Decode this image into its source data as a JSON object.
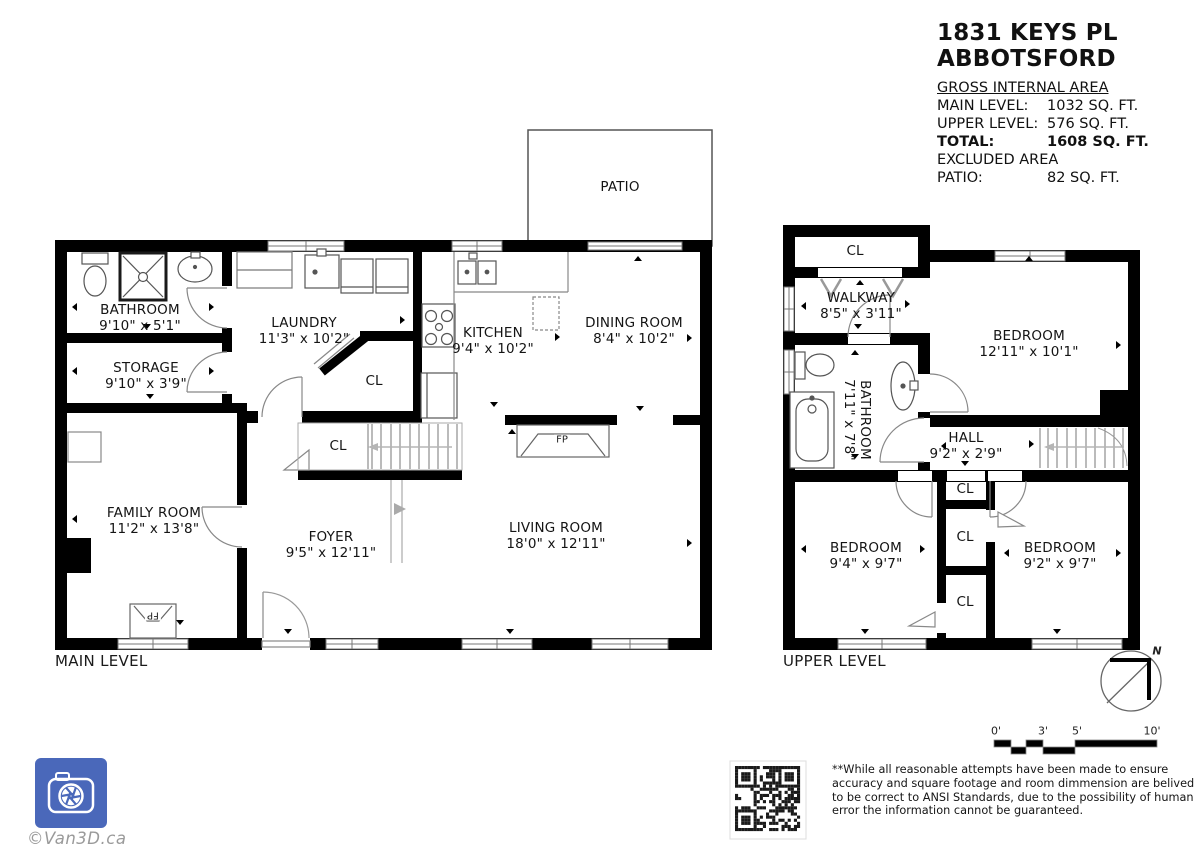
{
  "header": {
    "address_line1": "1831 KEYS PL",
    "address_line2": "ABBOTSFORD",
    "gross_title": "GROSS INTERNAL AREA",
    "rows": [
      {
        "label": "MAIN LEVEL:",
        "value": "1032 SQ. FT."
      },
      {
        "label": "UPPER LEVEL:",
        "value": "576 SQ. FT."
      },
      {
        "label": "TOTAL:",
        "value": "1608 SQ. FT."
      }
    ],
    "excluded_title": "EXCLUDED AREA",
    "excluded_row": {
      "label": "PATIO:",
      "value": "82 SQ. FT."
    }
  },
  "main_level": {
    "title": "MAIN LEVEL",
    "rooms": [
      {
        "name": "BATHROOM",
        "dims": "9'10\" x 5'1\""
      },
      {
        "name": "STORAGE",
        "dims": "9'10\" x 3'9\""
      },
      {
        "name": "LAUNDRY",
        "dims": "11'3\" x 10'2\""
      },
      {
        "name": "KITCHEN",
        "dims": "9'4\" x 10'2\""
      },
      {
        "name": "DINING ROOM",
        "dims": "8'4\" x 10'2\""
      },
      {
        "name": "FAMILY ROOM",
        "dims": "11'2\" x 13'8\""
      },
      {
        "name": "FOYER",
        "dims": "9'5\" x 12'11\""
      },
      {
        "name": "LIVING ROOM",
        "dims": "18'0\" x 12'11\""
      },
      {
        "name": "PATIO",
        "dims": ""
      }
    ],
    "closet_labels": [
      "CL",
      "CL"
    ],
    "fireplace_labels": [
      "FP",
      "FP"
    ]
  },
  "upper_level": {
    "title": "UPPER LEVEL",
    "rooms": [
      {
        "name": "WALKWAY",
        "dims": "8'5\" x 3'11\""
      },
      {
        "name": "BEDROOM",
        "dims": "12'11\" x 10'1\""
      },
      {
        "name": "BATHROOM",
        "dims": "7'11\" x 7'8\""
      },
      {
        "name": "HALL",
        "dims": "9'2\" x 2'9\""
      },
      {
        "name": "BEDROOM",
        "dims": "9'4\" x 9'7\""
      },
      {
        "name": "BEDROOM",
        "dims": "9'2\" x 9'7\""
      }
    ],
    "closet_labels": [
      "CL",
      "CL",
      "CL",
      "CL"
    ]
  },
  "scale": {
    "labels": [
      "0'",
      "3'",
      "5'",
      "10'"
    ]
  },
  "compass": {
    "north": "N"
  },
  "footer": {
    "logo_caption": "©Van3D.ca",
    "disclaimer": "**While all reasonable attempts have been made to ensure accuracy and square footage and room dimmension are belived to be correct to ANSI Standards, due to the possibility of human error the information cannot be guaranteed.",
    "brand_blue": "#4a68ba"
  }
}
